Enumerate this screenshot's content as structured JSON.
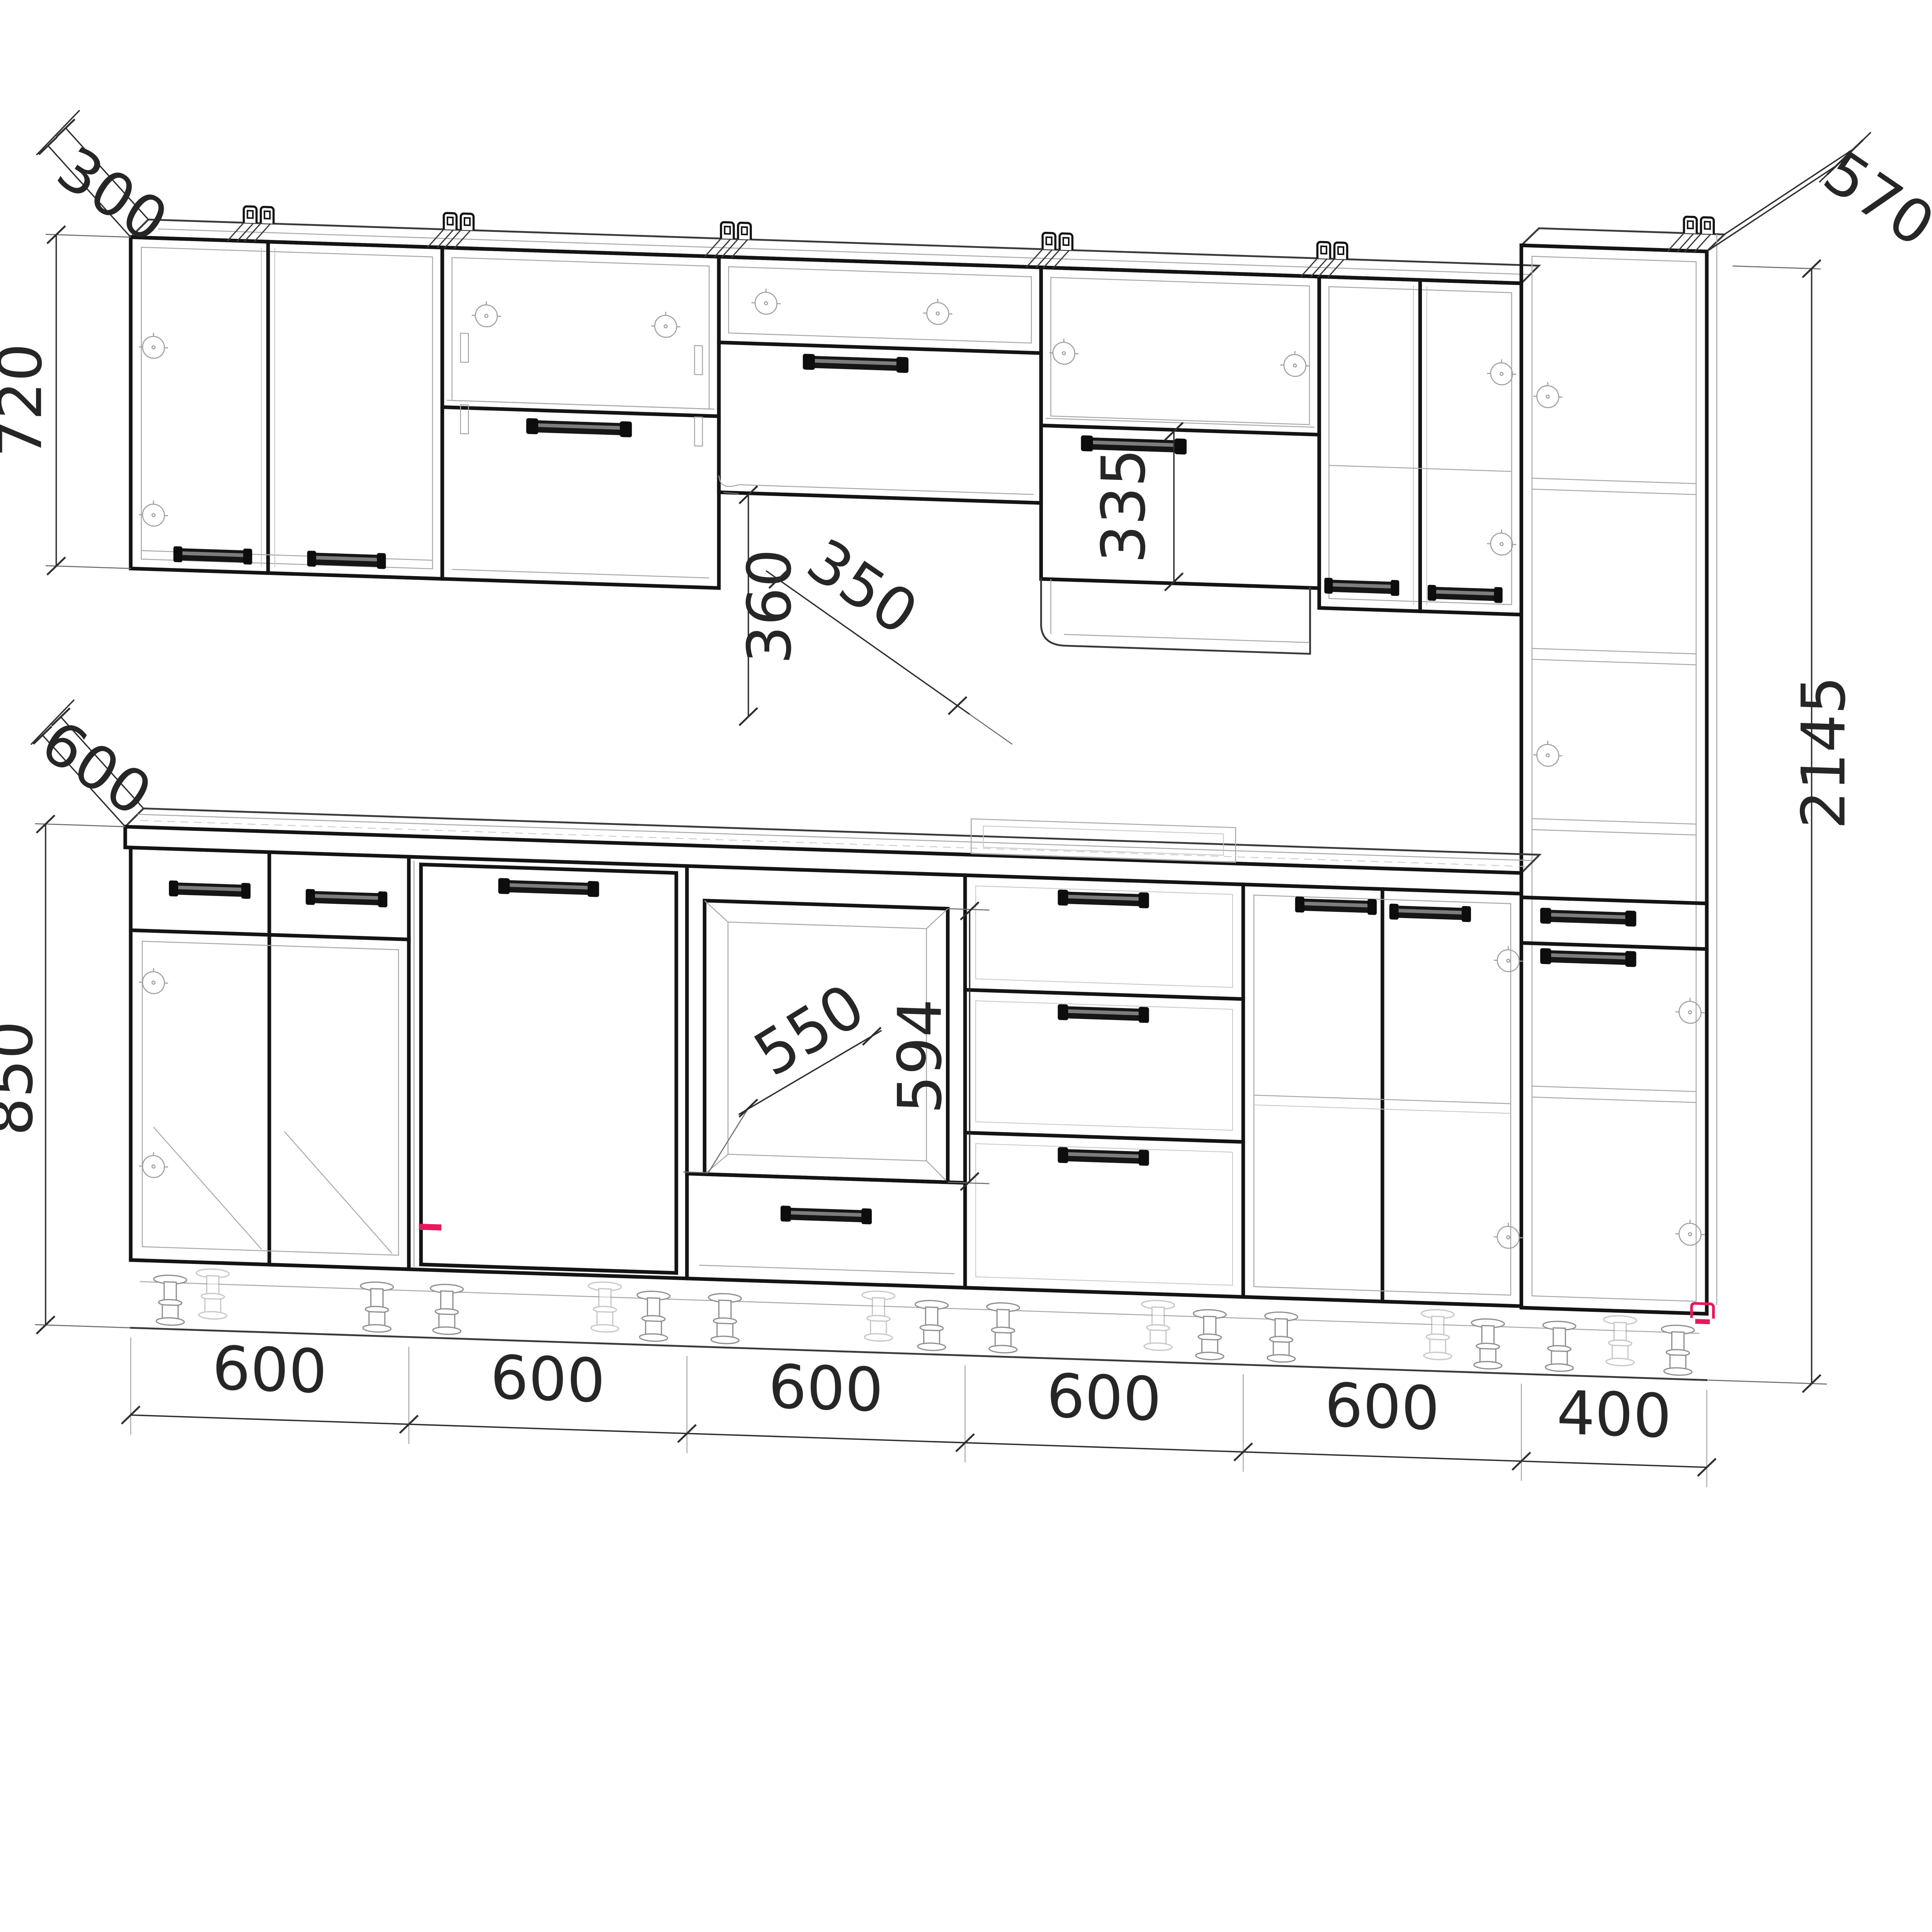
{
  "drawing": {
    "type": "kitchen-cabinet-elevation",
    "dimensions": {
      "wall_cabinet_depth": "300",
      "wall_cabinet_height": "720",
      "hood_gap_height": "360",
      "upper_cabinet_depth": "350",
      "flip_door_height": "335",
      "tall_cabinet_depth": "570",
      "tall_cabinet_height": "2145",
      "worktop_depth": "600",
      "base_cabinet_height": "850",
      "oven_niche_depth": "550",
      "oven_niche_height": "594",
      "base_widths": [
        "600",
        "600",
        "600",
        "600",
        "600",
        "400"
      ]
    },
    "colors": {
      "ink": "#141414",
      "hidden_line": "#a8a8a8",
      "dimension": "#2e2e2e",
      "accent": "#e8175f",
      "paper": "#ffffff"
    }
  }
}
